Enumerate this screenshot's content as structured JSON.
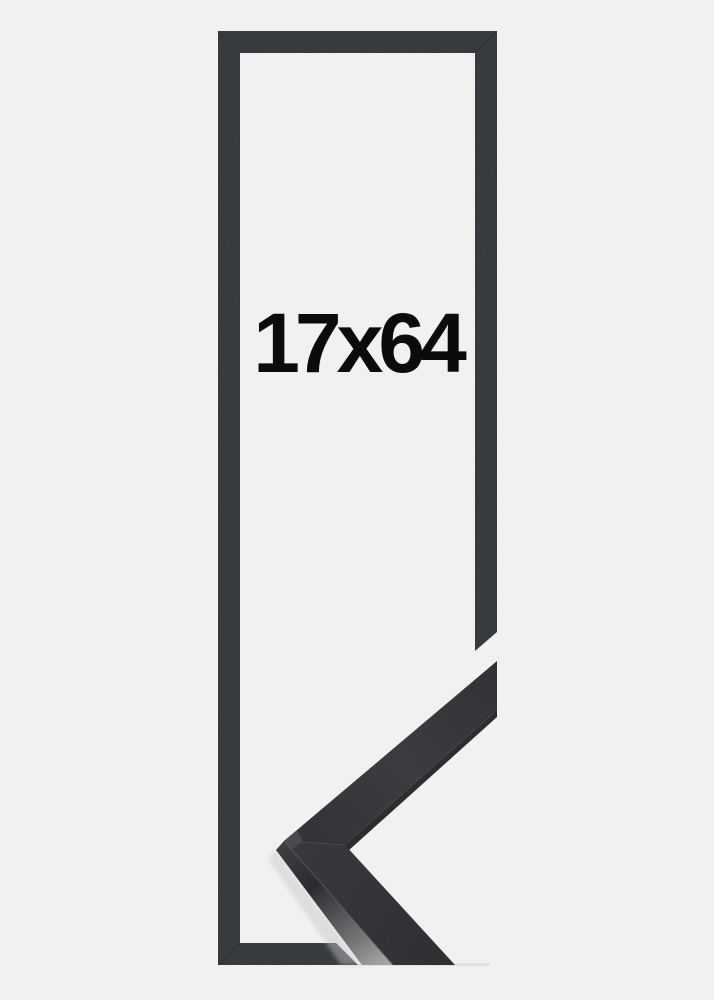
{
  "product": {
    "size_label": "17x64"
  },
  "colors": {
    "background": "#f1f1f2",
    "frame": "#323539",
    "sample_front_dark": "#2c2d30",
    "sample_front_light": "#35373b",
    "sample_side_light": "#a2a2a3",
    "sample_under_edge": "#1b1c1e",
    "label_text": "#0b0b0c"
  }
}
